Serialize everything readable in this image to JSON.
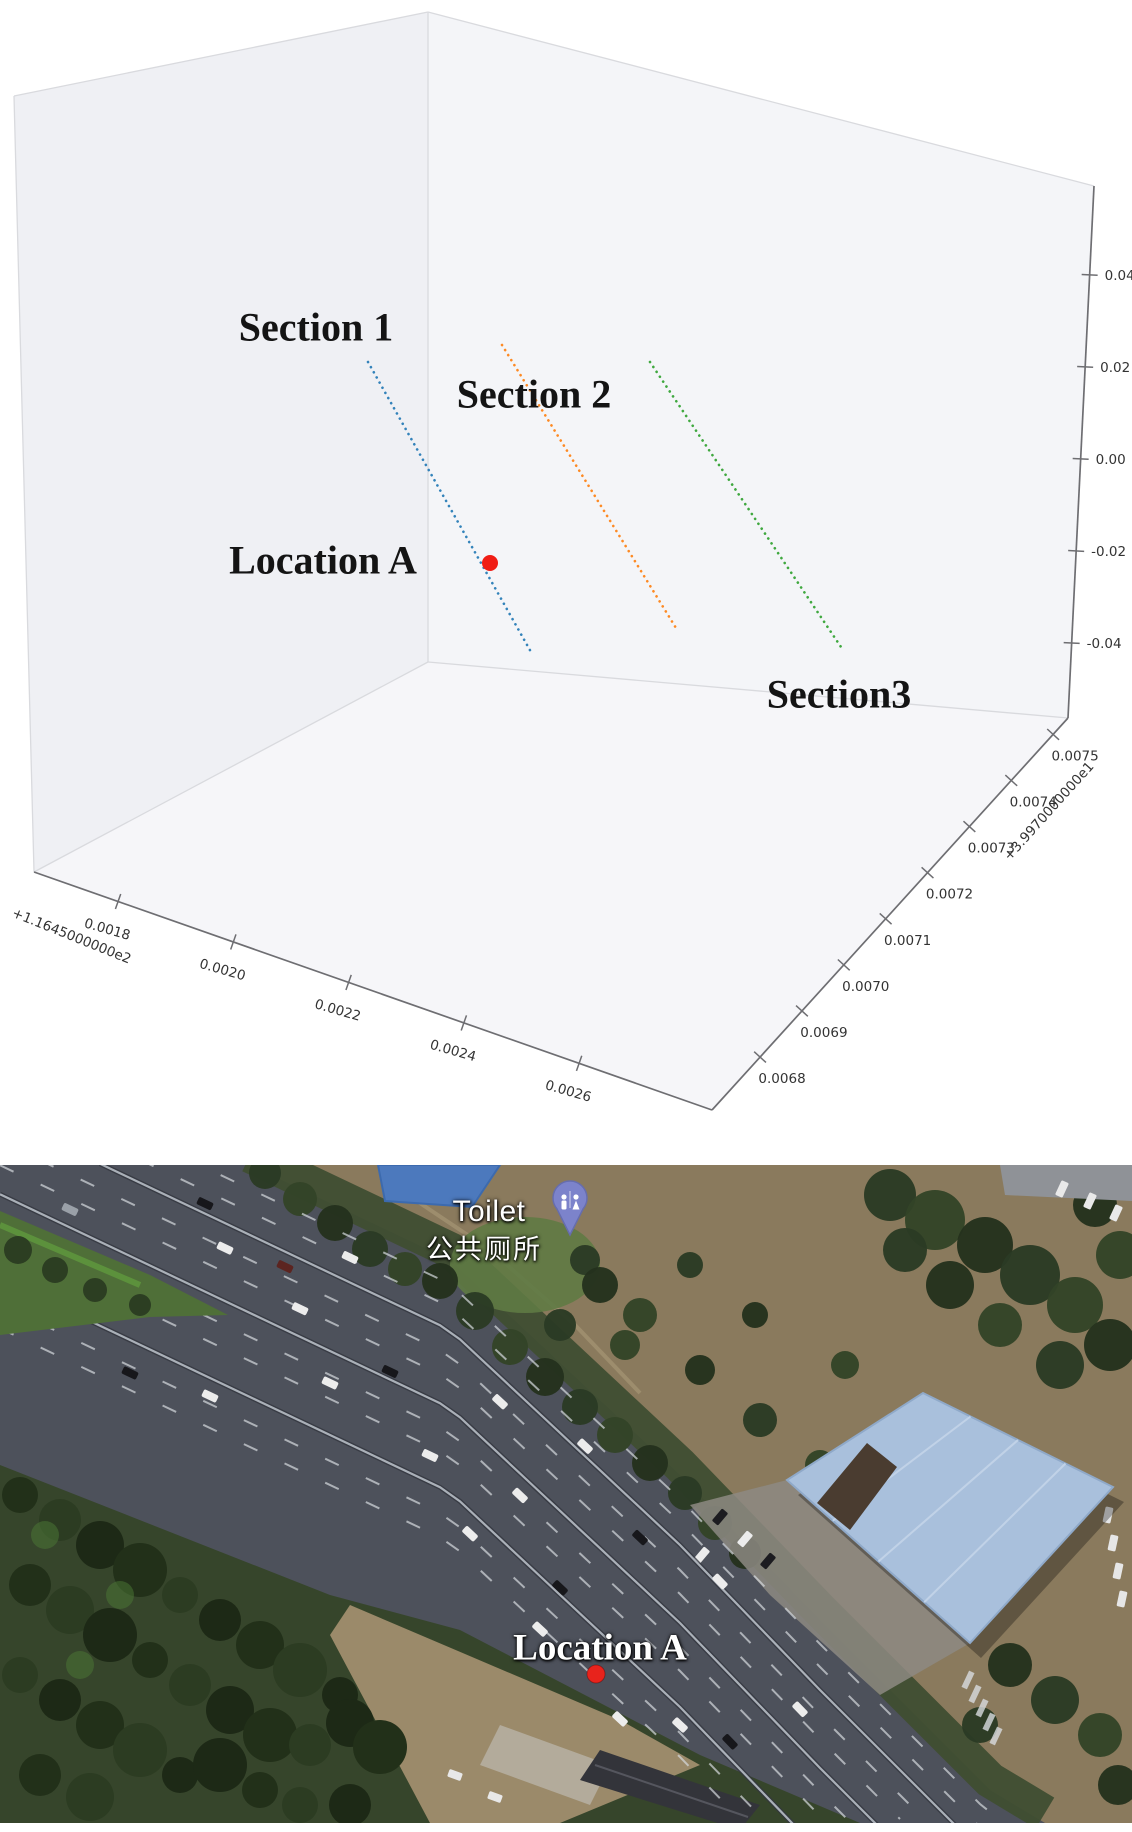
{
  "page": {
    "background": "#ffffff"
  },
  "chart_data": {
    "type": "scatter3d",
    "title": "",
    "legend_position": "none",
    "grid": false,
    "pane_colors": {
      "left_wall": "#eff0f4",
      "right_wall": "#f4f5f8",
      "floor": "#f6f6f9"
    },
    "series": [
      {
        "name": "Section 1",
        "color": "#1f77b4",
        "line_style": "dotted",
        "approx_xyz_start": [
          116.45195,
          39.9774,
          0.012
        ],
        "approx_xyz_end": [
          116.4522,
          39.977,
          -0.045
        ]
      },
      {
        "name": "Section 2",
        "color": "#ff7f0e",
        "line_style": "dotted",
        "approx_xyz_start": [
          116.45215,
          39.97745,
          0.012
        ],
        "approx_xyz_end": [
          116.45245,
          39.97705,
          -0.045
        ]
      },
      {
        "name": "Section3",
        "color": "#2ca02c",
        "line_style": "dotted",
        "approx_xyz_start": [
          116.4524,
          39.97748,
          0.01
        ],
        "approx_xyz_end": [
          116.45268,
          39.9771,
          -0.04
        ]
      }
    ],
    "marker": {
      "label": "Location A",
      "color": "#f01d15",
      "approx_xyz": [
        116.45207,
        39.97716,
        -0.018
      ]
    },
    "x_axis": {
      "offset_label": "+1.1645000000e2",
      "tick_labels": [
        "0.0018",
        "0.0020",
        "0.0022",
        "0.0024",
        "0.0026"
      ]
    },
    "y_axis": {
      "offset_label": "+3.9970000000e1",
      "tick_labels": [
        "0.0068",
        "0.0069",
        "0.0070",
        "0.0071",
        "0.0072",
        "0.0073",
        "0.0074",
        "0.0075"
      ]
    },
    "z_axis": {
      "tick_labels_top_to_bottom": [
        "0.04",
        "0.02",
        "0.00",
        "-0.02",
        "-0.04"
      ]
    }
  },
  "map": {
    "type": "satellite",
    "poi": {
      "name_en": "Toilet",
      "name_zh": "公共厕所",
      "pin_color": "#7c83cb"
    },
    "marker": {
      "label": "Location A",
      "dot_color": "#e8231c"
    },
    "colors": {
      "asphalt": "#4d515b",
      "dirt": "#8a7a5d",
      "tree_dark": "#2b3a24",
      "grass": "#4f6f38",
      "building_roof": "#a9c0dc",
      "pool": "#4c79bd"
    }
  }
}
